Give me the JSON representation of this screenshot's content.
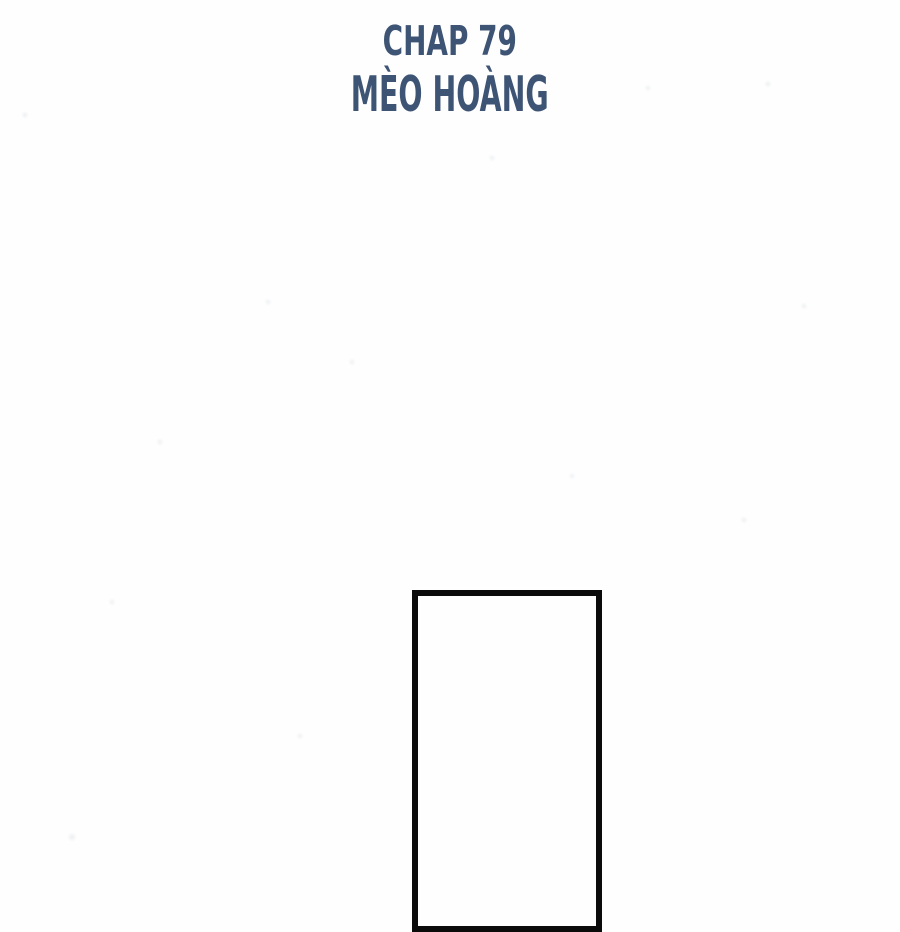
{
  "page": {
    "chapter_label": "CHAP 79",
    "chapter_title": "MÈO HOÀNG"
  },
  "colors": {
    "title_text": "#3e5474",
    "panel_border": "#0b0b0b",
    "background": "#fefefe"
  }
}
